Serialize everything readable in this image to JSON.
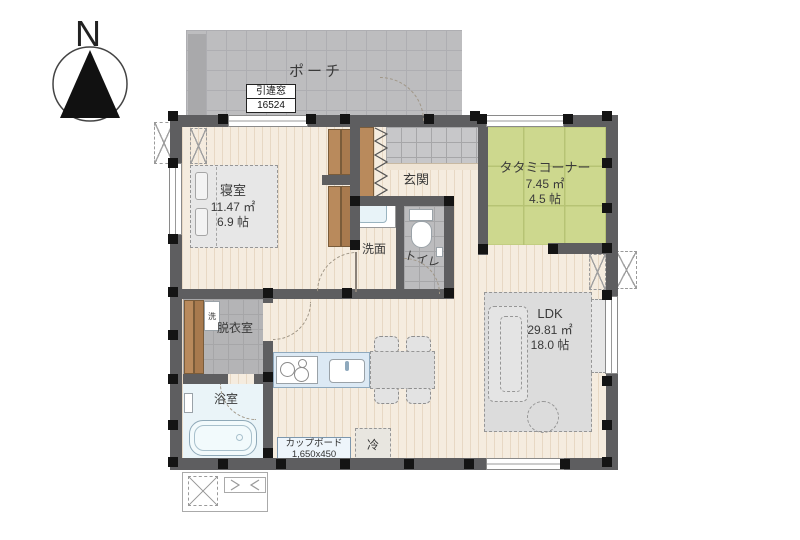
{
  "compass": {
    "label": "N"
  },
  "porch": {
    "label": "ポーチ"
  },
  "window_tag": {
    "name": "引違窓",
    "size": "16524"
  },
  "rooms": {
    "bedroom": {
      "name": "寝室",
      "area_m2": "11.47 ㎡",
      "area_jo": "6.9 帖"
    },
    "entrance": {
      "name": "玄関"
    },
    "tatami": {
      "name": "タタミコーナー",
      "area_m2": "7.45 ㎡",
      "area_jo": "4.5 帖"
    },
    "washroom": {
      "name": "洗面"
    },
    "toilet": {
      "name": "トイレ"
    },
    "dressing": {
      "name": "脱衣室"
    },
    "bath": {
      "name": "浴室"
    },
    "ldk": {
      "name": "LDK",
      "area_m2": "29.81 ㎡",
      "area_jo": "18.0 帖"
    }
  },
  "fixtures": {
    "cupboard": {
      "name": "カップボード",
      "size": "1,650x450"
    },
    "fridge": {
      "label": "冷"
    },
    "washer": {
      "label": "洗"
    }
  },
  "colors": {
    "tatami_green": "#cdd88e",
    "floor_wood": "#f5ecdf",
    "porch_gray": "#bdbdbf",
    "wall_gray": "#5e5e60",
    "bath_blue": "#eaf4f8",
    "kitchen_blue": "#dce9f4"
  }
}
